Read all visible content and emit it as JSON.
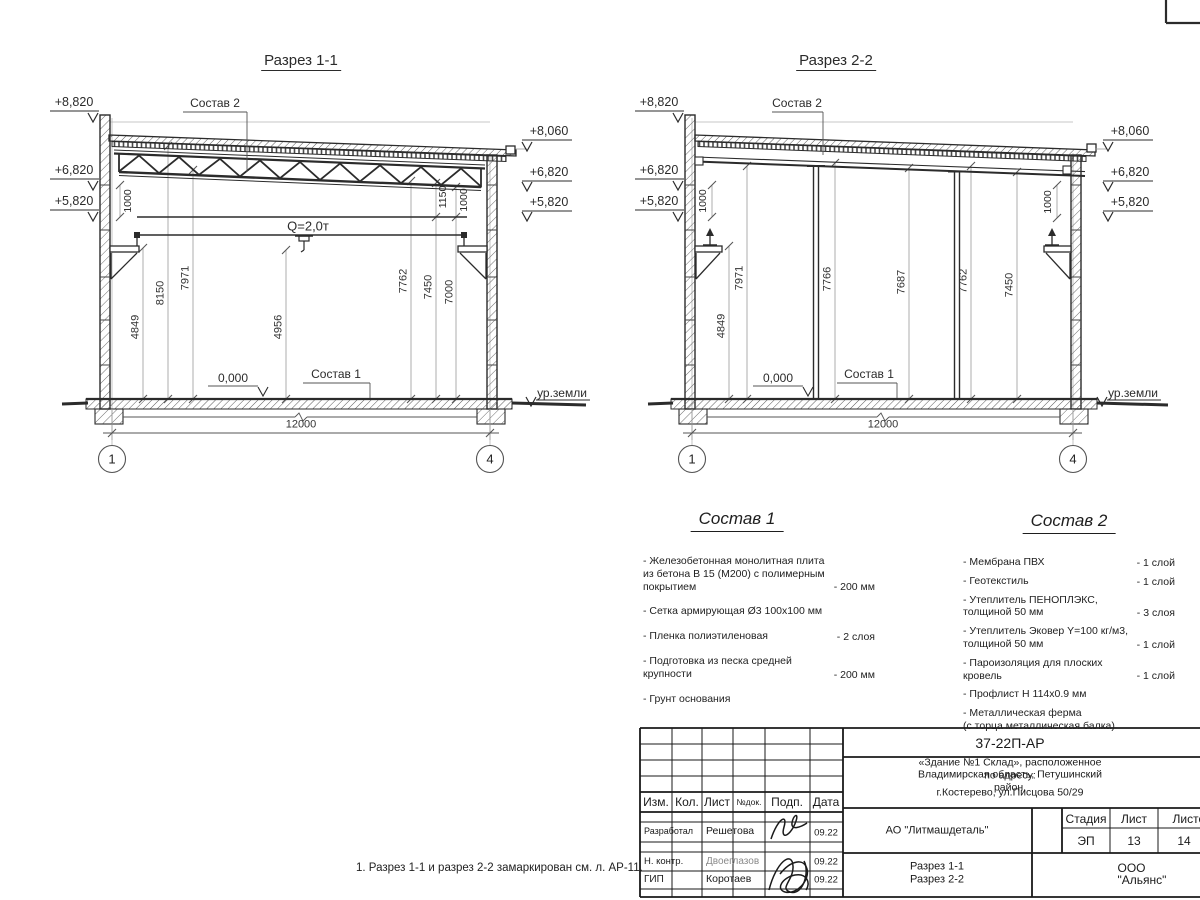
{
  "drawing": {
    "note": "1. Разрез 1-1 и разрез 2-2 замаркирован см. л. АР-11."
  },
  "section1": {
    "title": "Разрез 1-1",
    "elev_left": [
      "+8,820",
      "+6,820",
      "+5,820"
    ],
    "elev_right": [
      "+8,060",
      "+6,820",
      "+5,820"
    ],
    "comp2_ref": "Состав 2",
    "comp1_ref": "Состав 1",
    "crane_label": "Q=2,0т",
    "level_zero": "0,000",
    "ground_label": "ур.земли",
    "span_dim": "12000",
    "grid_left": "1",
    "grid_right": "4",
    "vdims": [
      "4849",
      "8150",
      "7971",
      "4956",
      "7762",
      "7450",
      "7000"
    ],
    "small_dims": [
      "1000",
      "1150",
      "1000"
    ]
  },
  "section2": {
    "title": "Разрез 2-2",
    "elev_left": [
      "+8,820",
      "+6,820",
      "+5,820"
    ],
    "elev_right": [
      "+8,060",
      "+6,820",
      "+5,820"
    ],
    "comp2_ref": "Состав 2",
    "comp1_ref": "Состав 1",
    "level_zero": "0,000",
    "ground_label": "ур.земли",
    "span_dim": "12000",
    "grid_left": "1",
    "grid_right": "4",
    "vdims": [
      "4849",
      "7971",
      "7766",
      "7687",
      "7762",
      "7450"
    ],
    "small_dims": [
      "1000",
      "1000"
    ]
  },
  "composition1": {
    "title": "Состав 1",
    "items": [
      {
        "text": "- Железобетонная  монолитная плита\nиз бетона В 15 (М200) с полимерным\nпокрытием",
        "value": "- 200 мм"
      },
      {
        "text": "- Сетка армирующая Ø3 100х100 мм",
        "value": ""
      },
      {
        "text": "- Пленка полиэтиленовая",
        "value": "-  2 слоя"
      },
      {
        "text": "- Подготовка из песка средней\n  крупности",
        "value": "- 200 мм"
      },
      {
        "text": "- Грунт основания",
        "value": ""
      }
    ]
  },
  "composition2": {
    "title": "Состав 2",
    "items": [
      {
        "text": "- Мембрана ПВХ",
        "value": "- 1 слой"
      },
      {
        "text": "- Геотекстиль",
        "value": "- 1 слой"
      },
      {
        "text": "- Утеплитель ПЕНОПЛЭКС,\n  толщиной 50 мм",
        "value": "- 3 слоя"
      },
      {
        "text": "- Утеплитель Эковер Y=100 кг/м3,\n  толщиной 50 мм",
        "value": "- 1 слой"
      },
      {
        "text": "- Пароизоляция для плоских кровель",
        "value": "- 1 слой"
      },
      {
        "text": "- Профлист Н 114х0.9 мм",
        "value": ""
      },
      {
        "text": "- Металлическая ферма\n  (с торца металлическая балка)",
        "value": ""
      }
    ]
  },
  "titleblock": {
    "doc_number": "37-22П-АР",
    "address_line1": "«Здание №1 Склад», расположенное по адресу:",
    "address_line2": "Владимирская область, Петушинский район,",
    "address_line3": "г.Костерево, ул.Писцова 50/29",
    "col_izm": "Изм.",
    "col_kol": "Кол.",
    "col_list": "Лист",
    "col_ndok": "№док.",
    "col_podp": "Подп.",
    "col_data": "Дата",
    "rows": [
      {
        "role": "Разработал",
        "name": "Решетова",
        "date": "09.22"
      },
      {
        "role": "Н. контр.",
        "name": "Двоеглазов",
        "date": "09.22"
      },
      {
        "role": "ГИП",
        "name": "Коротаев",
        "date": "09.22"
      }
    ],
    "company": "АО \"Литмашдеталь\"",
    "stage_label": "Стадия",
    "sheet_label": "Лист",
    "sheets_label": "Листов",
    "stage": "ЭП",
    "sheet": "13",
    "sheets": "14",
    "content_line1": "Разрез 1-1",
    "content_line2": "Разрез 2-2",
    "contractor": "ООО \"Альянс\""
  }
}
